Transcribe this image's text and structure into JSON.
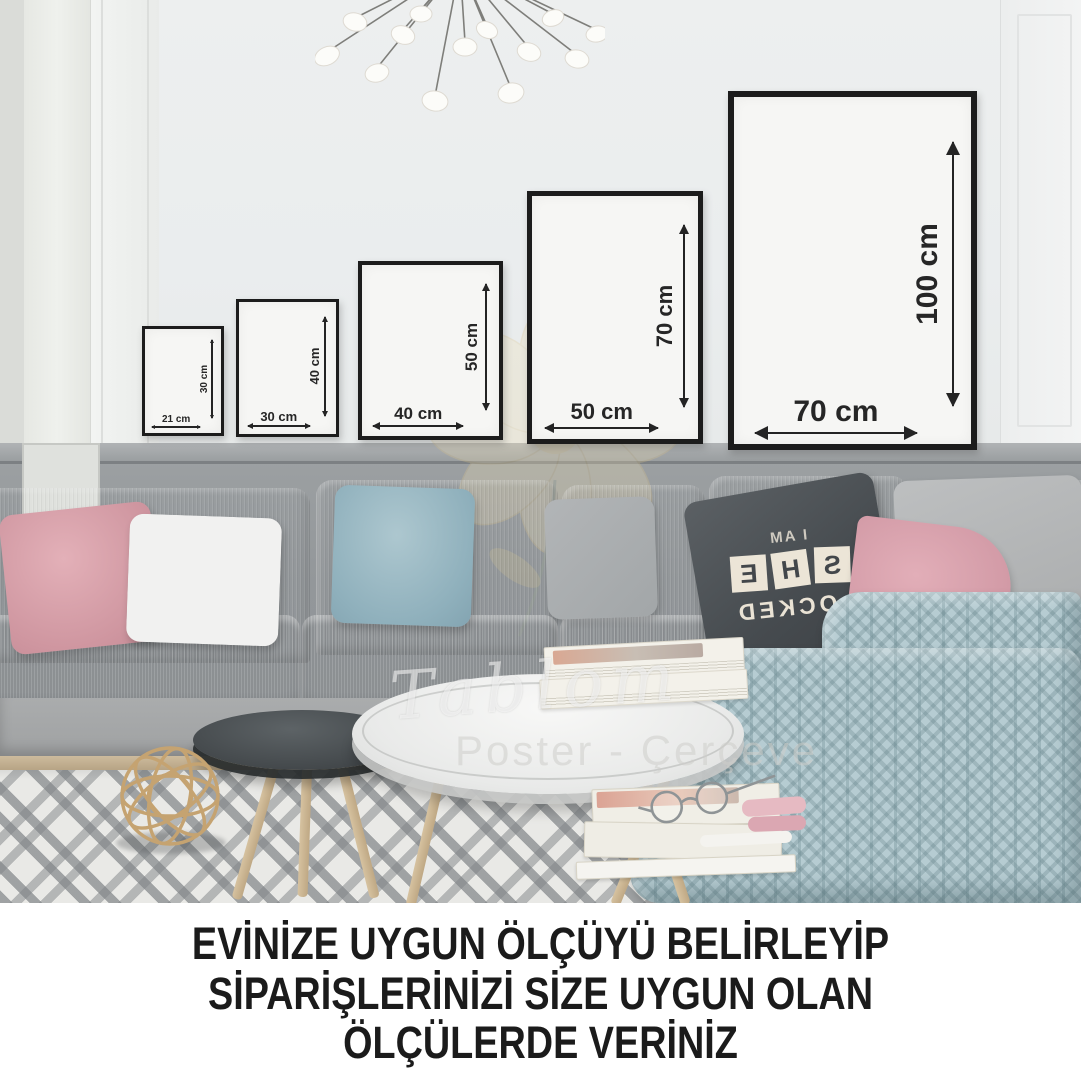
{
  "frames": [
    {
      "name": "frame-21x30",
      "width_label": "21 cm",
      "height_label": "30 cm"
    },
    {
      "name": "frame-30x40",
      "width_label": "30 cm",
      "height_label": "40 cm"
    },
    {
      "name": "frame-40x50",
      "width_label": "40 cm",
      "height_label": "50 cm"
    },
    {
      "name": "frame-50x70",
      "width_label": "50 cm",
      "height_label": "70 cm"
    },
    {
      "name": "frame-70x100",
      "width_label": "70 cm",
      "height_label": "100 cm"
    }
  ],
  "pillow": {
    "top_text": "I AM",
    "blocks": [
      "S",
      "H",
      "E"
    ],
    "bottom_text": "LOCKED"
  },
  "watermark": {
    "brand": "Tablom",
    "subtitle": "Poster - Çerçeve"
  },
  "caption": {
    "line1": "EVİNİZE UYGUN ÖLÇÜYÜ BELİRLEYİP",
    "line2": "SİPARİŞLERİNİZİ SİZE UYGUN OLAN",
    "line3": "ÖLÇÜLERDE VERİNİZ"
  },
  "colors": {
    "frame_border": "#1c1c1c",
    "frame_fill": "#f6f6f4",
    "dimension_text": "#262626",
    "wall_upper": "#eceeee",
    "wall_wainscot": "#94989b",
    "sofa_fabric": "#b3b5b6",
    "pink_pillow": "#d9a4ae",
    "blue_pillow": "#8fb0bc",
    "blanket": "#b6ccd2",
    "rug_pattern": "#82868a",
    "caption_text": "#1b1b1b"
  }
}
